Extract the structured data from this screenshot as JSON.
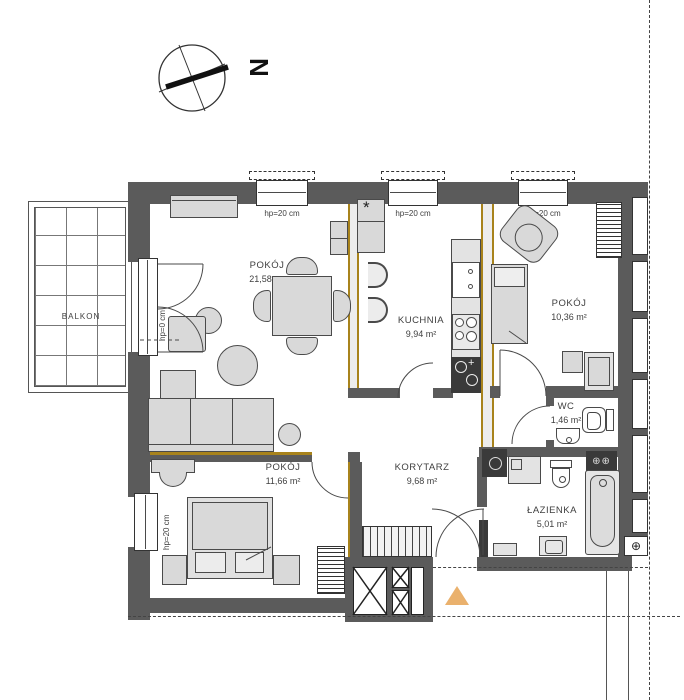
{
  "compass": {
    "north_label": "N"
  },
  "rooms": {
    "balcony": {
      "name": "BALKON"
    },
    "living": {
      "name": "POKÓJ",
      "area": "21,58 m²"
    },
    "kitchen": {
      "name": "KUCHNIA",
      "area": "9,94 m²"
    },
    "room2": {
      "name": "POKÓJ",
      "area": "10,36 m²"
    },
    "wc": {
      "name": "WC",
      "area": "1,46 m²"
    },
    "hall": {
      "name": "KORYTARZ",
      "area": "9,68 m²"
    },
    "bath": {
      "name": "ŁAZIENKA",
      "area": "5,01 m²"
    },
    "bedroom": {
      "name": "POKÓJ",
      "area": "11,66 m²"
    }
  },
  "labels": {
    "window_sill_height": "hp=20 cm",
    "balcony_door_height": "hp=0 cm",
    "boiler_marker": "*"
  },
  "colors": {
    "wall": "#5b5b5b",
    "partition_wood": "#a8831c",
    "furniture_fill": "#d9d9d9",
    "furniture_stroke": "#4a4a4a",
    "fixture_dark": "#3a3a3a",
    "entrance_marker": "#eab16d",
    "text": "#3f3f3f"
  }
}
